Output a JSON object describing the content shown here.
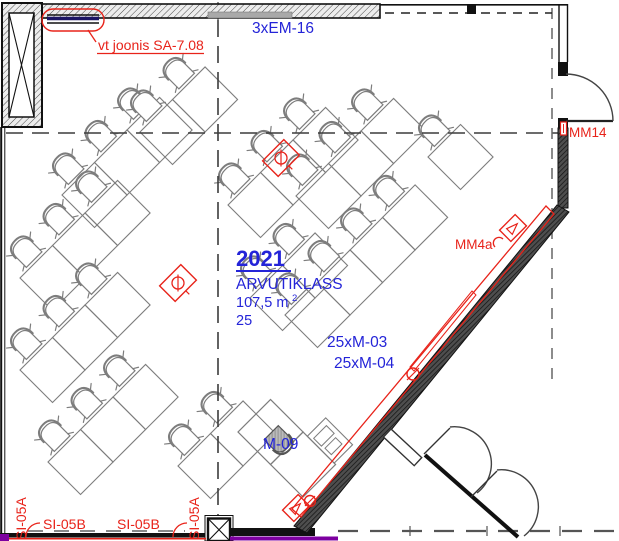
{
  "drawing": {
    "room": {
      "number": "2021",
      "name": "ARVUTIKLASS",
      "area": "107,5 m",
      "area_exp": "2",
      "capacity": "25"
    },
    "labels": {
      "em16": "3xEM-16",
      "note_beam": "vt joonis SA-7.08",
      "monitors_1": "25xM-03",
      "monitors_2": "25xM-04",
      "teacher_unit": "M-09",
      "mm4a": "MM4a",
      "mm14": "MM14",
      "si05b_1": "SI-05B",
      "si05b_2": "SI-05B",
      "si05a_left": "SI-05A",
      "si05a_mid": "SI-05A"
    },
    "colors": {
      "annotation_red": "#e8231a",
      "label_blue": "#2424d8",
      "beam_navy": "#1b1464",
      "cable_purple": "#7d00a0",
      "furniture_gray": "#7d7d7d"
    }
  }
}
